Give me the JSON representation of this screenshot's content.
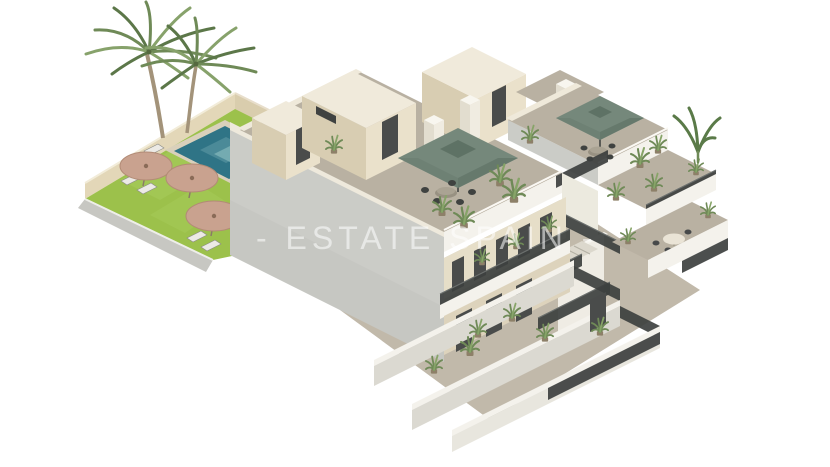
{
  "watermark": {
    "text": "- ESTATE SPAIN -"
  },
  "palette": {
    "background": "#ffffff",
    "wall_gray": "#cbccc7",
    "wall_gray_shade": "#c0c0bb",
    "wall_cream": "#eae1cb",
    "wall_cream_shade": "#d8cdb2",
    "roof_top": "#f0eadb",
    "parapet_white": "#f4f2ec",
    "floor_tan": "#b9b1a2",
    "floor_light": "#c1b9aa",
    "lawn_green": "#9cc14b",
    "pool_teal": "#2f7486",
    "pool_light": "#79aeb4",
    "umbrella_green": "#75887b",
    "umbrella_green_dark": "#5e7265",
    "parasol_wicker": "#c9a28f",
    "parasol_wicker_dark": "#b28b76",
    "railing_dark": "#3d403f",
    "door_dark": "#4a4c4b",
    "plant_green": "#6f8a57",
    "palm_trunk": "#a3937a",
    "beige_wall": "#e3d7b8",
    "beige_wall_shade": "#d9cdad",
    "deck_stone": "#d9d0bb",
    "lounger_white": "#eceae5",
    "table_round": "#989182"
  },
  "scene": {
    "type": "3d-architectural-render",
    "view": "aerial-isometric",
    "subject": "Two-storey terraced apartment complex with roof terraces, exterior staircase, balconies and communal pool garden",
    "areas": {
      "pool_garden": {
        "label": "Communal pool garden",
        "items": [
          "lawn",
          "swimming-pool",
          "palm-trees",
          "sun-loungers",
          "wicker-parasols",
          "perimeter-wall"
        ]
      },
      "roof_terrace_left": {
        "label": "Roof terrace, left block",
        "items": [
          "green-parasol",
          "dining-table",
          "chairs",
          "potted-plants",
          "stair-bulkheads",
          "chimney"
        ]
      },
      "roof_terrace_right": {
        "label": "Roof terrace, right block",
        "items": [
          "green-parasol",
          "dining-table",
          "chairs",
          "potted-plants"
        ]
      },
      "staircase": {
        "label": "Exterior staircase",
        "items": [
          "metal-railings",
          "stair-flights",
          "landing"
        ]
      },
      "gallery": {
        "label": "First-floor access gallery",
        "items": [
          "railing",
          "apartment-doors",
          "potted-plants"
        ]
      },
      "balconies_right": {
        "label": "Stepped balconies",
        "items": [
          "railings",
          "potted-plants",
          "round-table",
          "chairs",
          "banana-plant"
        ]
      },
      "ground_patios": {
        "label": "Ground-floor patios",
        "items": [
          "dividing-walls",
          "privacy-fences",
          "glass-doors",
          "potted-plants"
        ]
      }
    }
  }
}
